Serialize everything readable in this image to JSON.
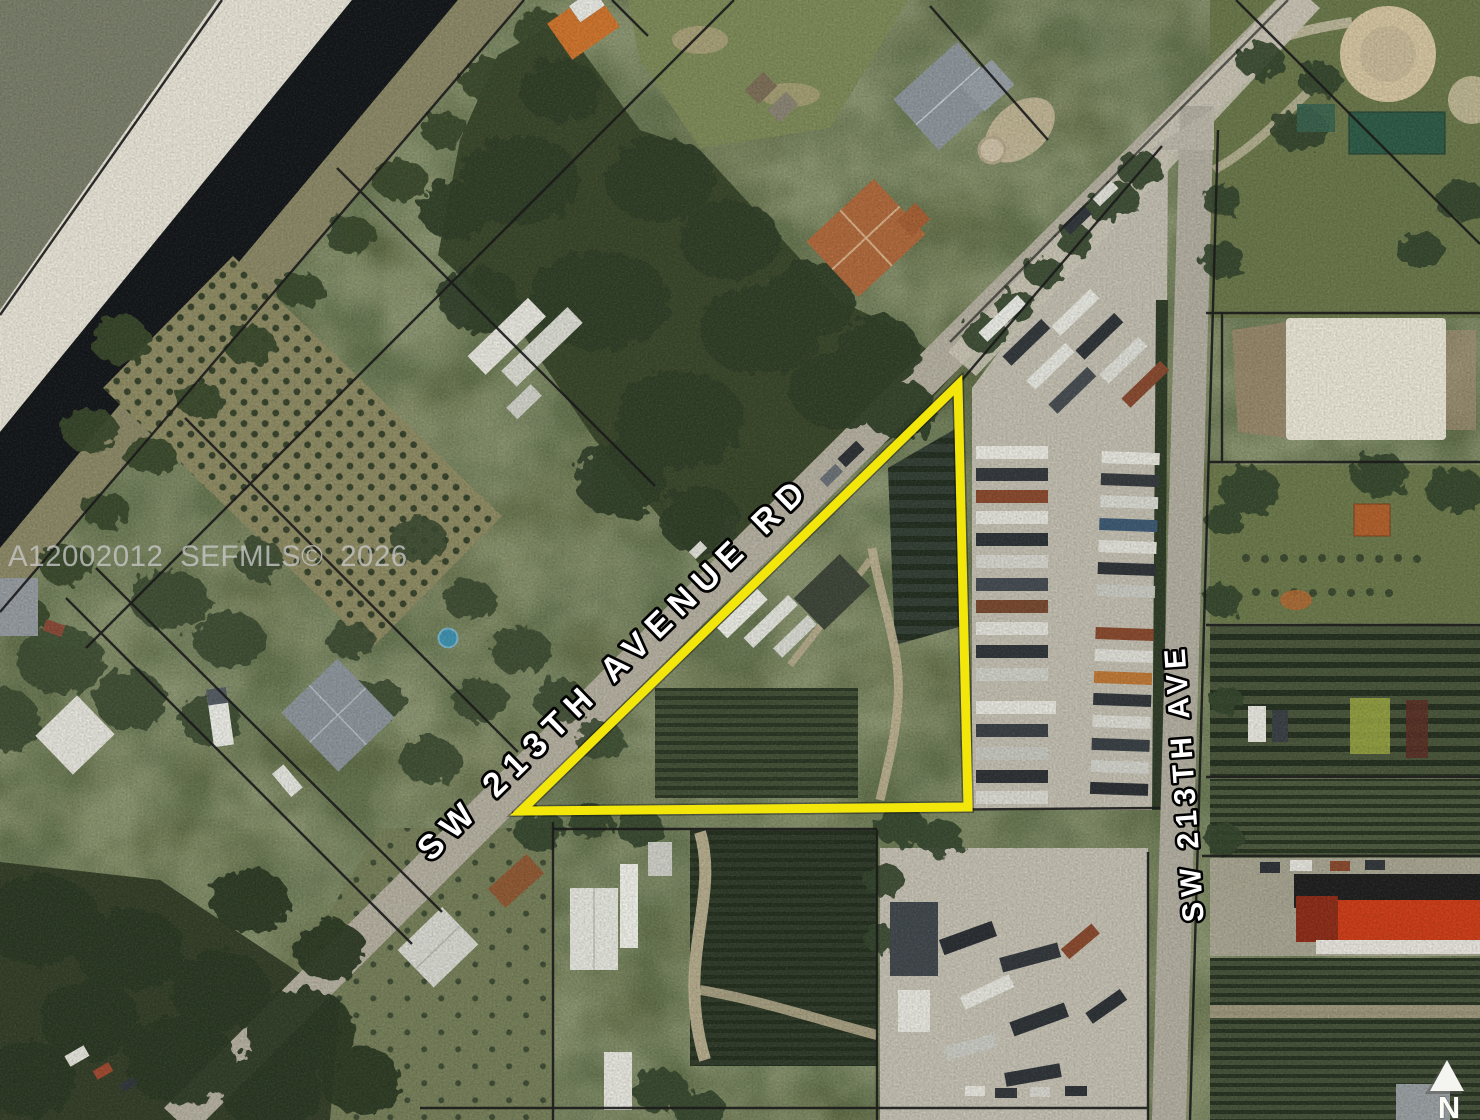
{
  "map": {
    "watermark_text": "A12002012 SEFMLS© 2026",
    "labels": {
      "diagonal_road": "SW 213TH AVENUE RD",
      "vertical_road": "SW 213TH AVE",
      "north": "N"
    },
    "colors": {
      "parcel_highlight": "#f3e60b",
      "road_label_fill": "#ffffff",
      "road_label_outline": "#000000",
      "watermark": "#c8c8c8",
      "boundary_line": "#1c1c1c"
    }
  }
}
